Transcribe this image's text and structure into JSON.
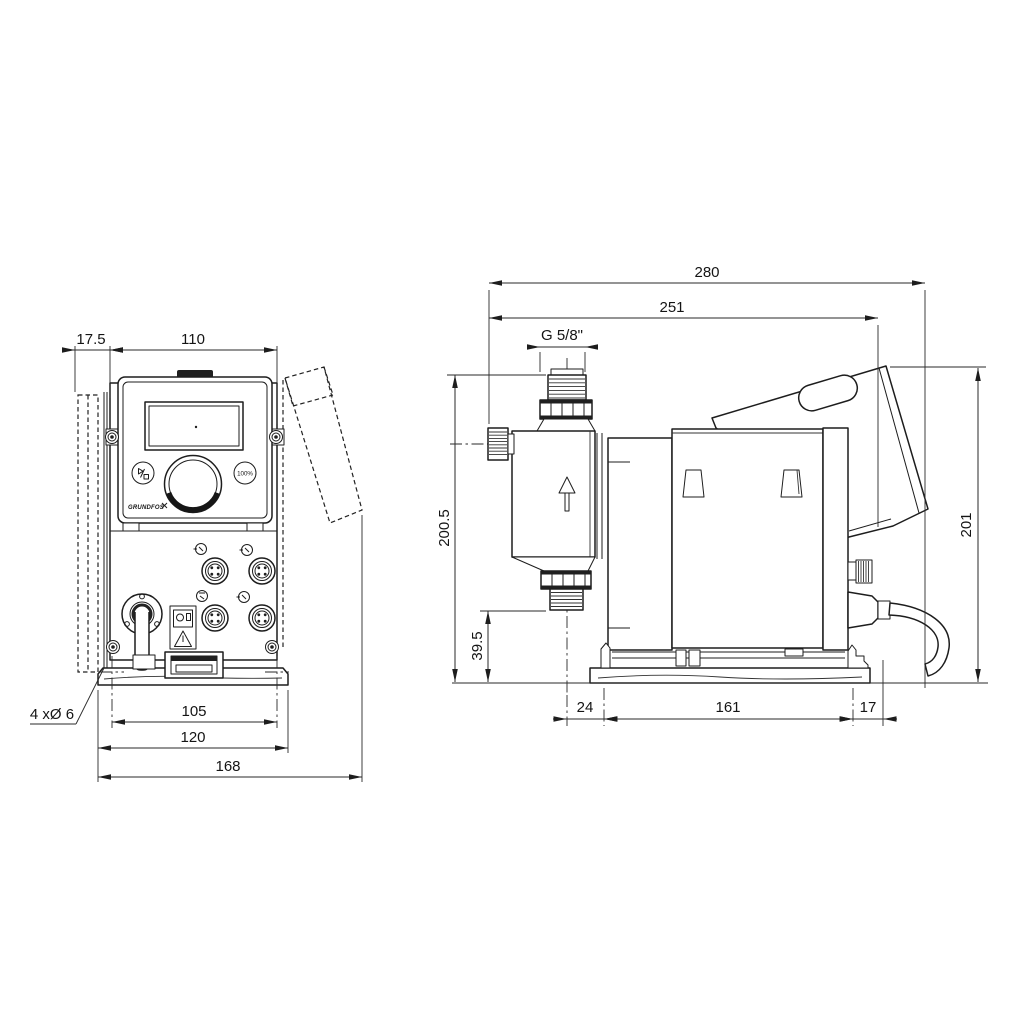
{
  "colors": {
    "background": "#ffffff",
    "line": "#1d1d1d",
    "dim_line": "#2a2a2a"
  },
  "drawing": {
    "front": {
      "dim_offset": "17.5",
      "dim_width": "110",
      "dim_holes": "105",
      "dim_plate": "120",
      "dim_overall": "168",
      "holes_note": "4 xØ 6",
      "btn_100": "100%",
      "logo": "GRUNDFOS"
    },
    "side": {
      "dim_depth_overall": "280",
      "dim_depth": "251",
      "thread_label": "G 5/8\"",
      "dim_height_head": "200.5",
      "dim_valve": "39.5",
      "dim_height": "201",
      "dim_front": "24",
      "dim_base": "161",
      "dim_rear": "17"
    }
  }
}
